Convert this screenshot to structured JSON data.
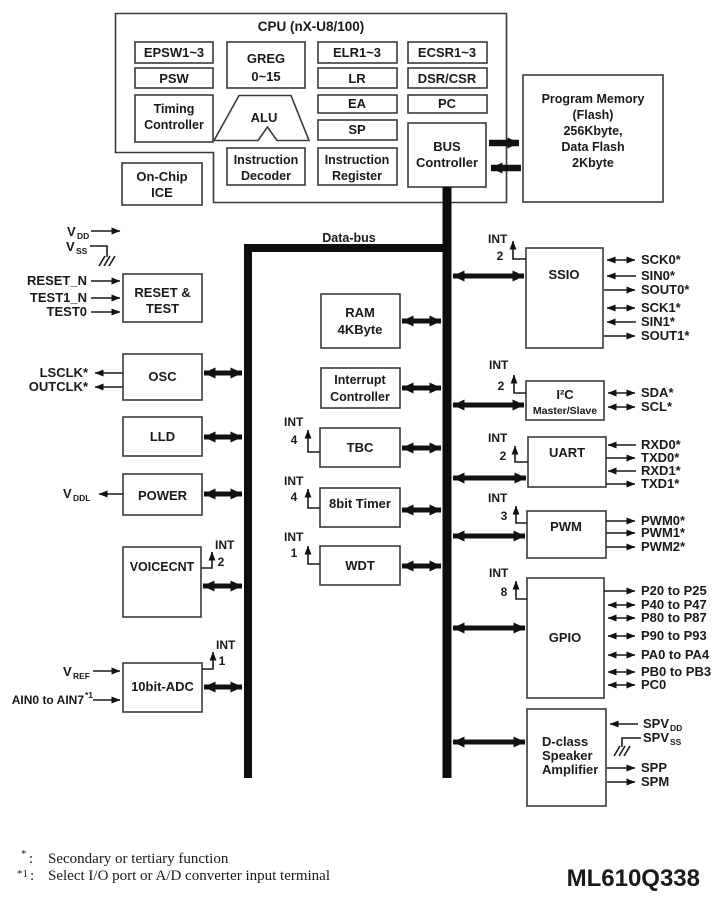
{
  "ink": "#1a1a1a",
  "cpu": {
    "title": "CPU (nX-U8/100)",
    "epsw": "EPSW1~3",
    "psw": "PSW",
    "timing": [
      "Timing",
      "Controller"
    ],
    "greg": [
      "GREG",
      "0~15"
    ],
    "alu": "ALU",
    "decoder": [
      "Instruction",
      "Decoder"
    ],
    "elr": "ELR1~3",
    "lr": "LR",
    "ea": "EA",
    "sp": "SP",
    "ireg": [
      "Instruction",
      "Register"
    ],
    "ecsr": "ECSR1~3",
    "dsr_csr": "DSR/CSR",
    "pc": "PC",
    "bus_controller": [
      "BUS",
      "Controller"
    ]
  },
  "on_chip_ice": [
    "On-Chip",
    "ICE"
  ],
  "program_memory": [
    "Program Memory",
    "(Flash)",
    "256Kbyte,",
    "Data Flash",
    "2Kbyte"
  ],
  "data_bus_label": "Data-bus",
  "power_pins": {
    "vdd": "V",
    "vdd_sub": "DD",
    "vss": "V",
    "vss_sub": "SS",
    "vddl": "V",
    "vddl_sub": "DDL",
    "vref": "V",
    "vref_sub": "REF"
  },
  "left_modules": {
    "reset_test": {
      "label": [
        "RESET &",
        "TEST"
      ],
      "inputs": [
        "RESET_N",
        "TEST1_N",
        "TEST0"
      ]
    },
    "osc": {
      "label": "OSC",
      "outputs": [
        "LSCLK*",
        "OUTCLK*"
      ]
    },
    "lld": {
      "label": "LLD"
    },
    "power": {
      "label": "POWER"
    },
    "voicecnt": {
      "label": "VOICECNT",
      "int": "INT",
      "int_count": "2"
    },
    "adc": {
      "label": "10bit-ADC",
      "int": "INT",
      "int_count": "1",
      "ain": "AIN0 to AIN7",
      "ain_sup": "*1"
    }
  },
  "center_modules": {
    "ram": [
      "RAM",
      "4KByte"
    ],
    "int_controller": [
      "Interrupt",
      "Controller"
    ],
    "tbc": {
      "label": "TBC",
      "int": "INT",
      "int_count": "4"
    },
    "timer8": {
      "label": "8bit Timer",
      "int": "INT",
      "int_count": "4"
    },
    "wdt": {
      "label": "WDT",
      "int": "INT",
      "int_count": "1"
    }
  },
  "right_modules": {
    "ssio": {
      "label": "SSIO",
      "int": "INT",
      "int_count": "2",
      "signals": [
        "SCK0*",
        "SIN0*",
        "SOUT0*",
        "SCK1*",
        "SIN1*",
        "SOUT1*"
      ]
    },
    "i2c": {
      "label": "I²C",
      "sublabel": "Master/Slave",
      "int": "INT",
      "int_count": "2",
      "signals": [
        "SDA*",
        "SCL*"
      ]
    },
    "uart": {
      "label": "UART",
      "int": "INT",
      "int_count": "2",
      "signals": [
        "RXD0*",
        "TXD0*",
        "RXD1*",
        "TXD1*"
      ]
    },
    "pwm": {
      "label": "PWM",
      "int": "INT",
      "int_count": "3",
      "signals": [
        "PWM0*",
        "PWM1*",
        "PWM2*"
      ]
    },
    "gpio": {
      "label": "GPIO",
      "int": "INT",
      "int_count": "8",
      "signals": [
        "P20 to P25",
        "P40 to P47",
        "P80 to P87",
        "P90 to P93",
        "PA0 to PA4",
        "PB0 to PB3",
        "PC0"
      ]
    },
    "dclass": {
      "label": [
        "D-class",
        "Speaker",
        "Amplifier"
      ],
      "spv": "SPV",
      "dd_sub": "DD",
      "ss_sub": "SS",
      "spp": "SPP",
      "spm": "SPM"
    }
  },
  "footer": {
    "fn1_marker": "*",
    "fn1_sep": ":",
    "fn1_text": "Secondary or tertiary function",
    "fn2_marker": "*1",
    "fn2_sep": ":",
    "fn2_text": "Select I/O port or A/D converter input terminal",
    "part_number": "ML610Q338"
  }
}
